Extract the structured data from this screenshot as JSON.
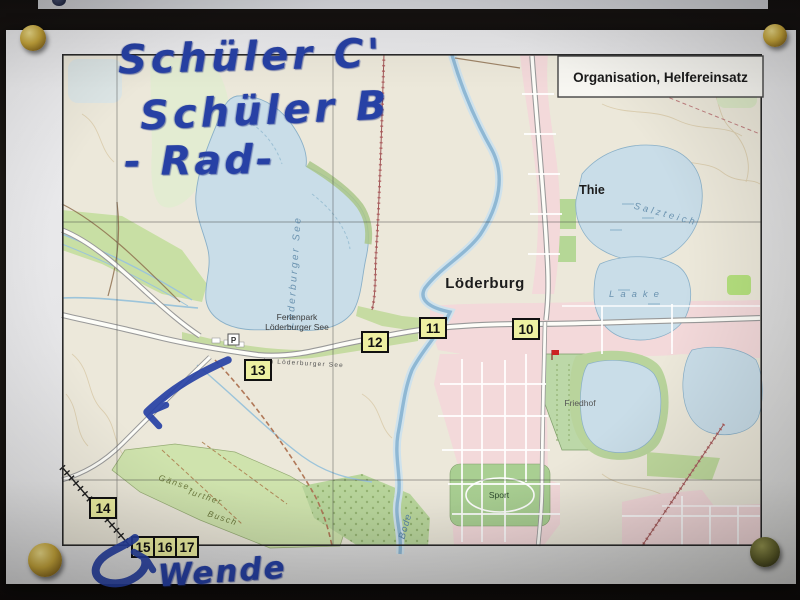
{
  "annotations": {
    "line1": "Schüler C'",
    "line2": "Schüler B",
    "line3": "- Rad-",
    "turn_label": "Wende"
  },
  "map": {
    "title_box": {
      "label": "Organisation, Helfereinsatz"
    },
    "towns": {
      "loederburg": "Löderburg",
      "thie": "Thie"
    },
    "water": {
      "lake_name": "Löderburger See",
      "salzteich": "Salzteich",
      "laake": "Laake",
      "bode": "Bode"
    },
    "places": {
      "ferienpark_line1": "Ferienpark",
      "ferienpark_line2": "Löderburger See",
      "street_am_see": "Am Löderburger See",
      "sport": "Sport",
      "friedhof": "Friedhof",
      "busch_line1": "Gänse-",
      "busch_line2": "further",
      "busch_line3": "Busch",
      "parking": "P"
    },
    "markers": [
      {
        "label": "10"
      },
      {
        "label": "11"
      },
      {
        "label": "12"
      },
      {
        "label": "13"
      },
      {
        "label": "14"
      },
      {
        "label": "15"
      },
      {
        "label": "16"
      },
      {
        "label": "17"
      }
    ]
  },
  "colors": {
    "handwriting_ink": "#2741a5",
    "marker_box_fill": "#eef0a2",
    "water_fill": "#c9dde8",
    "forest_fill": "#cfe3ad",
    "settlement_fill": "#f3d9da",
    "paper": "#e6e6e8",
    "board": "#1b1713",
    "pin_gold": "#c9a83c"
  }
}
